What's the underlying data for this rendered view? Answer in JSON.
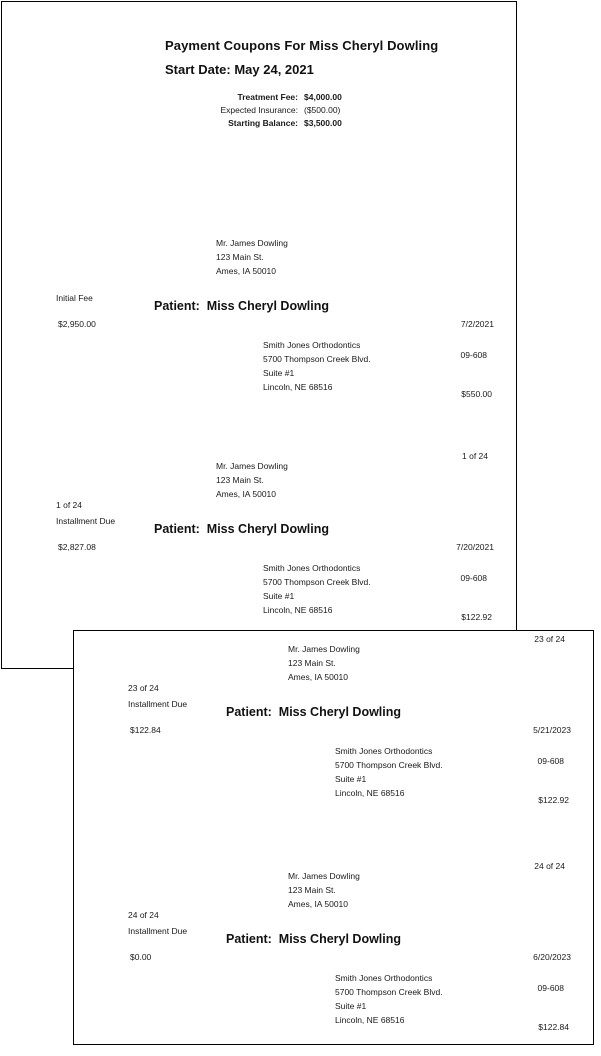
{
  "document": {
    "title": "Payment Coupons For Miss Cheryl Dowling",
    "start_date": "Start Date: May 24, 2021",
    "summary": {
      "treatment_fee_label": "Treatment Fee:",
      "treatment_fee_value": "$4,000.00",
      "expected_insurance_label": "Expected Insurance:",
      "expected_insurance_value": "($500.00)",
      "starting_balance_label": "Starting Balance:",
      "starting_balance_value": "$3,500.00"
    }
  },
  "pages": [
    {
      "coupons": [
        {
          "corner": "",
          "recipient": [
            "Mr. James Dowling",
            "123 Main St.",
            "Ames, IA 50010"
          ],
          "sequence": "",
          "fee_type": "Initial Fee",
          "patient": "Patient:  Miss Cheryl Dowling",
          "balance": "$2,950.00",
          "date": "7/2/2021",
          "payee": [
            "Smith Jones Orthodontics",
            "5700 Thompson Creek Blvd.",
            "Suite #1",
            "Lincoln, NE 68516"
          ],
          "account": "09-608",
          "amount": "$550.00"
        },
        {
          "corner": "1 of 24",
          "recipient": [
            "Mr. James Dowling",
            "123 Main St.",
            "Ames, IA 50010"
          ],
          "sequence": "1 of 24",
          "fee_type": "Installment Due",
          "patient": "Patient:  Miss Cheryl Dowling",
          "balance": "$2,827.08",
          "date": "7/20/2021",
          "payee": [
            "Smith Jones Orthodontics",
            "5700 Thompson Creek Blvd.",
            "Suite #1",
            "Lincoln, NE 68516"
          ],
          "account": "09-608",
          "amount": "$122.92"
        }
      ]
    },
    {
      "coupons": [
        {
          "corner": "23 of 24",
          "recipient": [
            "Mr. James Dowling",
            "123 Main St.",
            "Ames, IA 50010"
          ],
          "sequence": "23 of 24",
          "fee_type": "Installment Due",
          "patient": "Patient:  Miss Cheryl Dowling",
          "balance": "$122.84",
          "date": "5/21/2023",
          "payee": [
            "Smith Jones Orthodontics",
            "5700 Thompson Creek Blvd.",
            "Suite #1",
            "Lincoln, NE 68516"
          ],
          "account": "09-608",
          "amount": "$122.92"
        },
        {
          "corner": "24 of 24",
          "recipient": [
            "Mr. James Dowling",
            "123 Main St.",
            "Ames, IA 50010"
          ],
          "sequence": "24 of 24",
          "fee_type": "Installment Due",
          "patient": "Patient:  Miss Cheryl Dowling",
          "balance": "$0.00",
          "date": "6/20/2023",
          "payee": [
            "Smith Jones Orthodontics",
            "5700 Thompson Creek Blvd.",
            "Suite #1",
            "Lincoln, NE 68516"
          ],
          "account": "09-608",
          "amount": "$122.84"
        }
      ]
    }
  ]
}
